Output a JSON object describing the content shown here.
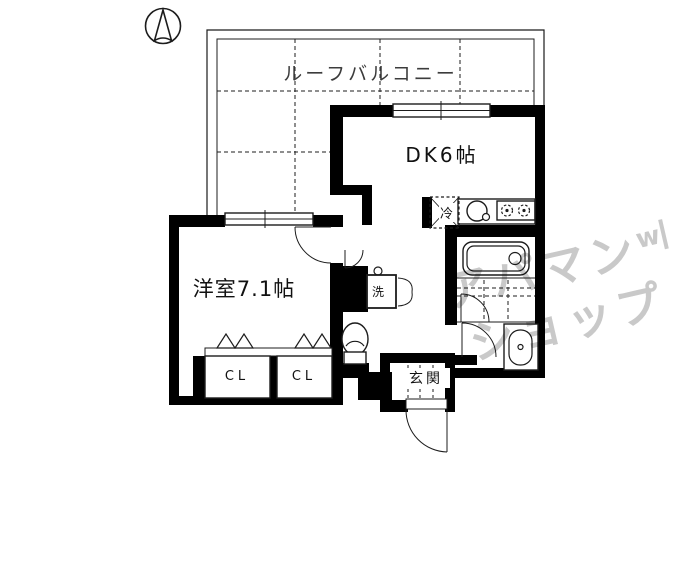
{
  "floor_plan": {
    "balcony_label": "ルーフバルコニー",
    "dk_label": "DK6帖",
    "bedroom_label": "洋室7.1帖",
    "fridge_label": "冷",
    "washer_label": "洗",
    "entrance_label": "玄関",
    "closet1_label": "CL",
    "closet2_label": "CL",
    "compass_icon": "north-arrow",
    "rooms": [
      {
        "name": "ルーフバルコニー",
        "type": "roof-balcony"
      },
      {
        "name": "DK",
        "size": "6帖"
      },
      {
        "name": "洋室",
        "size": "7.1帖"
      },
      {
        "name": "玄関",
        "type": "entrance"
      }
    ],
    "fixtures": [
      "refrigerator",
      "kitchen-sink",
      "gas-stove",
      "bathtub",
      "washbasin",
      "toilet",
      "washing-machine-pan",
      "closet",
      "closet"
    ],
    "colors": {
      "walls": "#000000",
      "lines": "#1c1c1c",
      "balcony_text": "#3c3c3c",
      "watermark": "#c9c9c9",
      "background": "#ffffff"
    }
  },
  "watermark": {
    "text": "アパマンショップ",
    "line1": "アパマン",
    "line2": "ショップ",
    "logo_mark": "w"
  }
}
